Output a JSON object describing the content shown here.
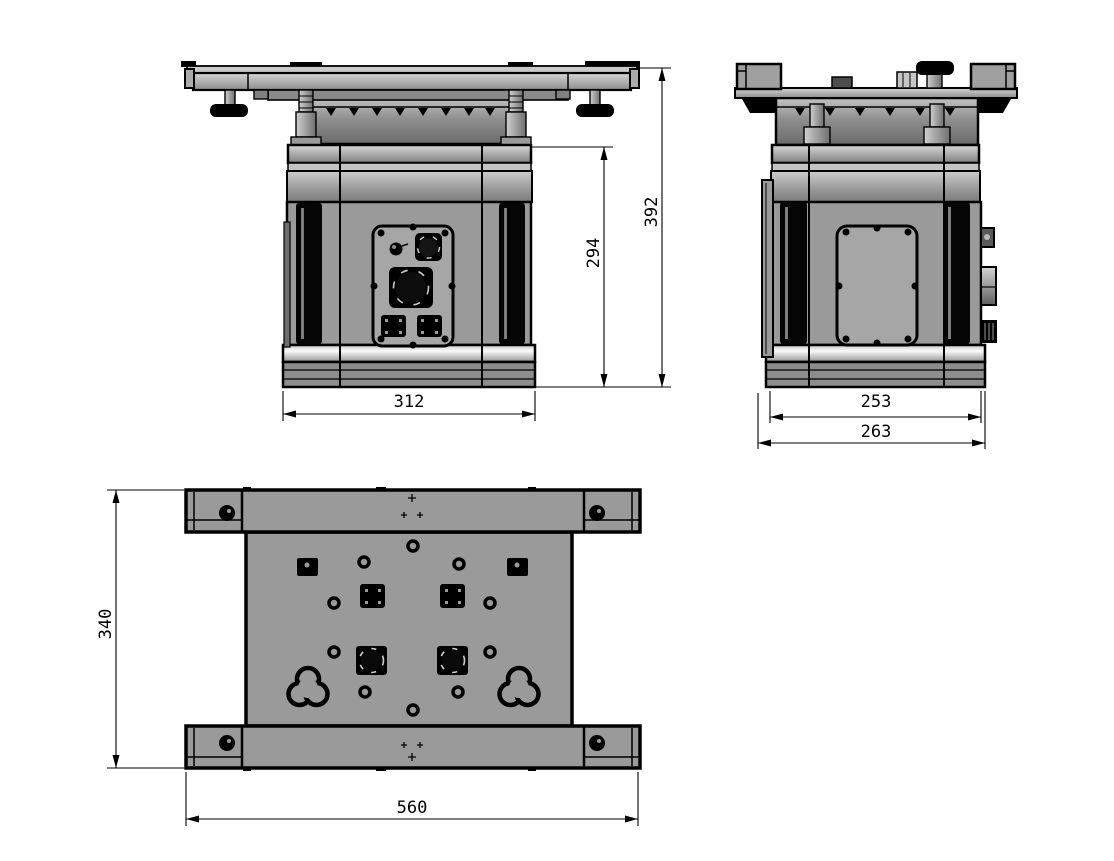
{
  "drawing": {
    "type": "engineering-orthographic-drawing",
    "views": {
      "front": {
        "label": "front-view",
        "dimensions": {
          "base_width": "312",
          "body_height": "294",
          "overall_height": "392"
        }
      },
      "side": {
        "label": "side-view",
        "dimensions": {
          "body_depth": "253",
          "overall_depth": "263"
        }
      },
      "top": {
        "label": "top-view",
        "dimensions": {
          "plate_depth": "340",
          "plate_width": "560"
        }
      }
    },
    "colors": {
      "background": "#ffffff",
      "line": "#000000",
      "body_gray": "#9a9a9a",
      "panel_gray": "#a6a6a6",
      "dark_gray": "#6e6e6e",
      "vent_black": "#050505",
      "highlight": "#fafafa"
    }
  }
}
